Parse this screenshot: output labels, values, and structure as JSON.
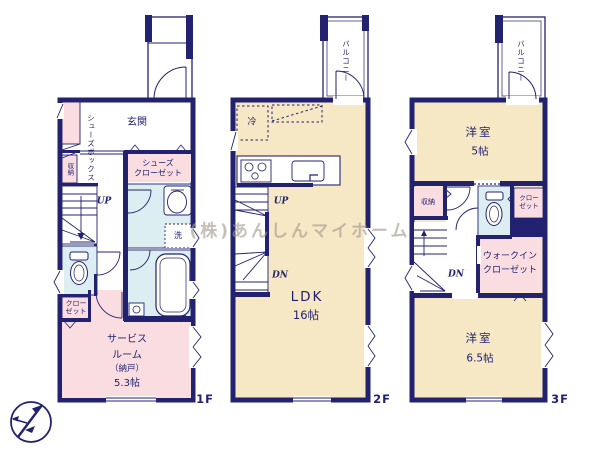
{
  "watermark": "(株)あんしんマイホーム",
  "colors": {
    "wall_navy": "#232270",
    "room_cream": "#f6e8c4",
    "room_pink": "#fadde1",
    "room_blue": "#dceef2",
    "watermark_gray": "rgba(162,152,140,0.62)"
  },
  "floors": {
    "f1": {
      "label": "1F",
      "rooms": {
        "genkan": "玄関",
        "shoes_box": "シューズボックス",
        "shoes_closet_l1": "シューズ",
        "shoes_closet_l2": "クローゼット",
        "storage": "収納",
        "up": "UP",
        "washer": "洗",
        "closet_l1": "クロー",
        "closet_l2": "ゼット",
        "service_l1": "サービス",
        "service_l2": "ルーム",
        "service_l3": "（納戸）",
        "service_l4": "5.3帖"
      }
    },
    "f2": {
      "label": "2F",
      "rooms": {
        "balcony": "バルコニー",
        "fridge": "冷",
        "up": "UP",
        "dn": "DN",
        "ldk": "LDK",
        "ldk_size": "16帖"
      }
    },
    "f3": {
      "label": "3F",
      "rooms": {
        "balcony": "バルコニー",
        "west_room_5": "洋室",
        "west_room_5_size": "5帖",
        "storage": "収納",
        "closet_l1": "クロー",
        "closet_l2": "ゼット",
        "wic_l1": "ウォークイン",
        "wic_l2": "クローゼット",
        "dn": "DN",
        "west_room_65": "洋室",
        "west_room_65_size": "6.5帖"
      }
    }
  }
}
